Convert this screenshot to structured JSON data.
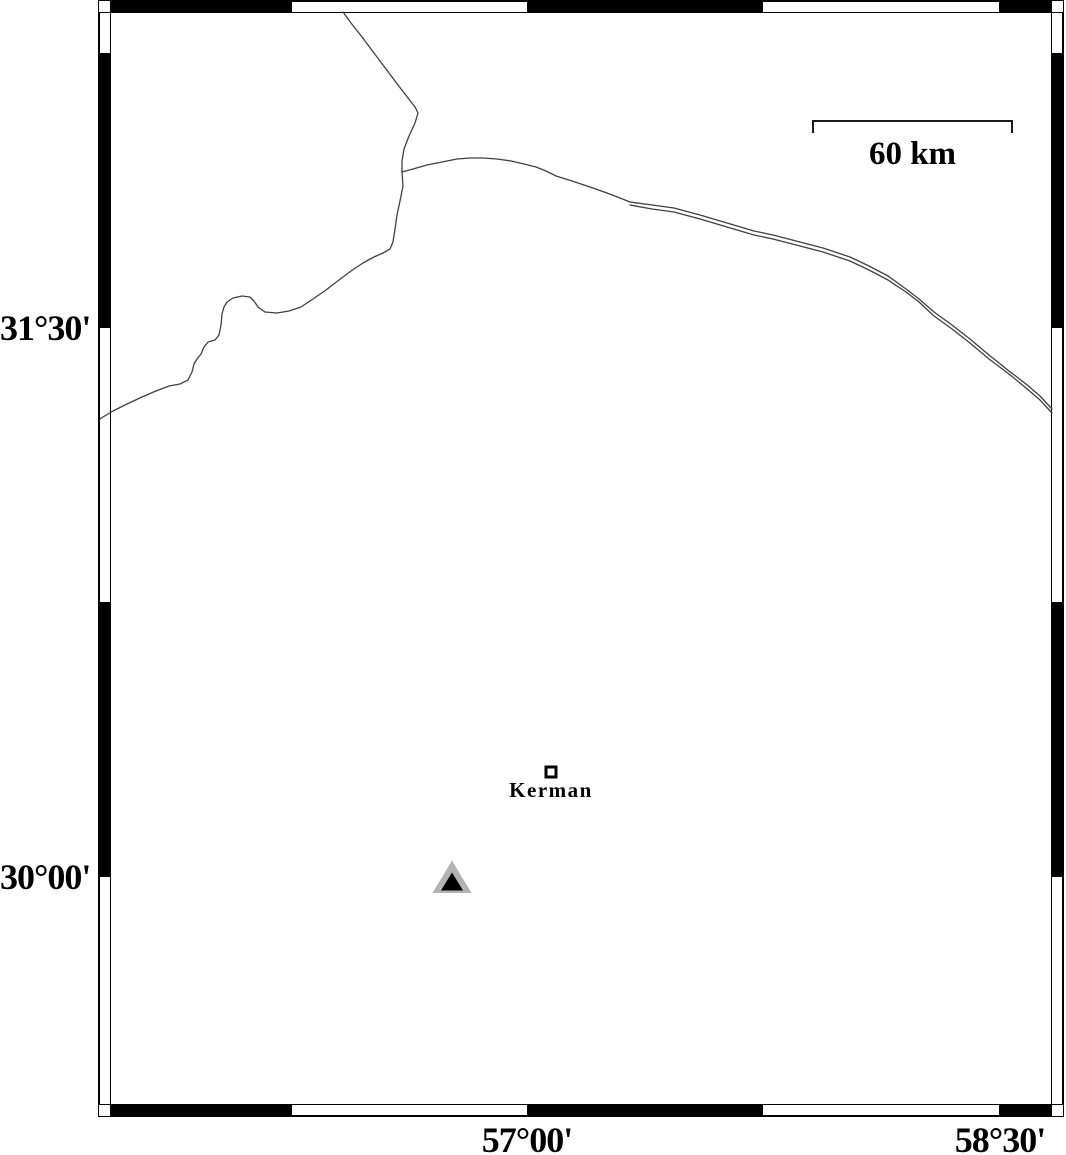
{
  "map": {
    "title": "Kerman region map",
    "background_color": "#ffffff",
    "frame_color": "#000000"
  },
  "frame": {
    "outer": {
      "x": 98,
      "y": 0,
      "w": 966,
      "h": 1117
    },
    "band": 13,
    "top_black_segments": [
      [
        110,
        292
      ],
      [
        527,
        763
      ],
      [
        999,
        1052
      ]
    ],
    "bottom_black_segments": [
      [
        110,
        292
      ],
      [
        527,
        763
      ],
      [
        999,
        1052
      ]
    ],
    "left_black_segments": [
      [
        53,
        328
      ],
      [
        602,
        877
      ]
    ],
    "right_black_segments": [
      [
        53,
        328
      ],
      [
        602,
        877
      ]
    ]
  },
  "axis_labels": {
    "left": [
      {
        "text": "31°30'",
        "y": 328
      },
      {
        "text": "30°00'",
        "y": 877
      }
    ],
    "bottom": [
      {
        "text": "57°00'",
        "x": 527
      },
      {
        "text": "58°30'",
        "x": 1000
      }
    ]
  },
  "scale_bar": {
    "label": "60 km",
    "x1": 813,
    "x2": 1012,
    "y": 121,
    "tick_drop": 12,
    "color": "#1a1a1a"
  },
  "city": {
    "name": "Kerman",
    "symbol": "square",
    "x": 551,
    "y": 772,
    "size": 13,
    "fill": "#ffffff",
    "stroke": "#000000"
  },
  "station": {
    "symbol": "triangle",
    "x": 452,
    "y": 882,
    "outer_fill": "#b3b3b3",
    "inner_fill": "#000000",
    "outer": [
      [
        452,
        860.5
      ],
      [
        432.5,
        893
      ],
      [
        471.5,
        893
      ]
    ],
    "inner": [
      [
        452,
        872.5
      ],
      [
        441,
        890.5
      ],
      [
        463,
        890.5
      ]
    ]
  },
  "boundary_lines": {
    "color": "#404040",
    "width": 1.3,
    "polylines": [
      [
        [
          343,
          12
        ],
        [
          351,
          23
        ],
        [
          362,
          37
        ],
        [
          374,
          53
        ],
        [
          386,
          69
        ],
        [
          398,
          85
        ],
        [
          408,
          98
        ],
        [
          415,
          107
        ],
        [
          418,
          113
        ],
        [
          415,
          123
        ],
        [
          409,
          136
        ],
        [
          404,
          149
        ],
        [
          402,
          161
        ],
        [
          402,
          172
        ]
      ],
      [
        [
          402,
          172
        ],
        [
          403,
          186
        ],
        [
          400,
          201
        ],
        [
          397,
          215
        ],
        [
          395,
          229
        ],
        [
          393,
          242
        ],
        [
          390,
          249
        ],
        [
          383,
          253
        ],
        [
          374,
          257
        ],
        [
          363,
          263
        ],
        [
          351,
          271
        ],
        [
          339,
          280
        ],
        [
          326,
          290
        ],
        [
          313,
          299
        ],
        [
          301,
          307
        ],
        [
          289,
          311
        ],
        [
          277,
          313
        ],
        [
          265,
          312
        ],
        [
          258,
          307
        ],
        [
          254,
          301
        ],
        [
          250,
          297
        ],
        [
          242,
          296
        ],
        [
          233,
          298
        ],
        [
          227,
          302
        ],
        [
          224,
          307
        ],
        [
          222,
          314
        ],
        [
          221,
          325
        ],
        [
          219,
          335
        ],
        [
          215,
          340
        ],
        [
          208,
          342
        ],
        [
          204,
          347
        ],
        [
          201,
          354
        ],
        [
          197,
          359
        ],
        [
          194,
          364
        ],
        [
          192,
          372
        ],
        [
          188,
          380
        ],
        [
          180,
          384
        ],
        [
          169,
          386
        ],
        [
          156,
          391
        ],
        [
          142,
          397
        ],
        [
          127,
          404
        ],
        [
          113,
          411
        ],
        [
          103,
          417
        ],
        [
          100,
          419
        ]
      ],
      [
        [
          402,
          172
        ],
        [
          413,
          169
        ],
        [
          427,
          165
        ],
        [
          442,
          162
        ],
        [
          457,
          159
        ],
        [
          470,
          158
        ],
        [
          483,
          158
        ],
        [
          497,
          159
        ],
        [
          511,
          161
        ],
        [
          524,
          164
        ],
        [
          536,
          167
        ],
        [
          546,
          171
        ],
        [
          556,
          176
        ],
        [
          572,
          181
        ],
        [
          590,
          187
        ],
        [
          607,
          193
        ],
        [
          620,
          198
        ],
        [
          630,
          202
        ]
      ],
      [
        [
          630,
          202
        ],
        [
          652,
          205
        ],
        [
          674,
          208
        ],
        [
          700,
          215
        ],
        [
          727,
          223
        ],
        [
          754,
          231
        ],
        [
          773,
          235
        ],
        [
          800,
          242
        ],
        [
          823,
          248
        ],
        [
          850,
          257
        ],
        [
          869,
          266
        ],
        [
          888,
          276
        ],
        [
          906,
          289
        ],
        [
          919,
          299
        ],
        [
          934,
          312
        ],
        [
          952,
          325
        ],
        [
          970,
          339
        ],
        [
          989,
          355
        ],
        [
          1009,
          371
        ],
        [
          1026,
          384
        ],
        [
          1040,
          396
        ],
        [
          1052,
          409
        ]
      ],
      [
        [
          630,
          205
        ],
        [
          652,
          209
        ],
        [
          674,
          212
        ],
        [
          700,
          219
        ],
        [
          727,
          227
        ],
        [
          754,
          235
        ],
        [
          773,
          239
        ],
        [
          800,
          246
        ],
        [
          823,
          252
        ],
        [
          850,
          261
        ],
        [
          869,
          270
        ],
        [
          888,
          280
        ],
        [
          906,
          292
        ],
        [
          919,
          302
        ],
        [
          934,
          316
        ],
        [
          952,
          329
        ],
        [
          970,
          343
        ],
        [
          989,
          359
        ],
        [
          1009,
          374
        ],
        [
          1026,
          388
        ],
        [
          1040,
          400
        ],
        [
          1052,
          413
        ]
      ]
    ]
  }
}
